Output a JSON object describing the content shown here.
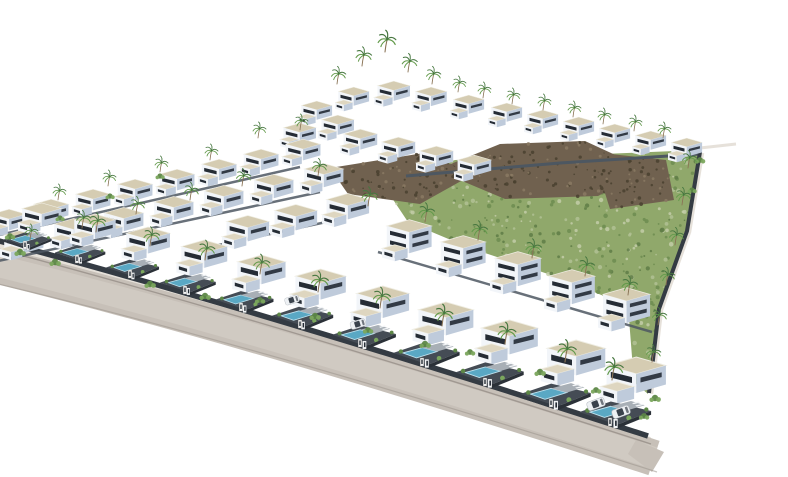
{
  "scene": {
    "name": "aerial-3d-render-villa-development",
    "colors": {
      "background": "#ffffff",
      "roof": "#d5ccb2",
      "roof2": "#ded6c0",
      "roofEdge": "#efede2",
      "faceLight": "#f2f5f9",
      "faceShade": "#bfcbdb",
      "window": "#252c35",
      "windowShade": "#323a45",
      "plot": "#454c55",
      "pool": "#5aa8c4",
      "poolEdge": "#bfe2ee",
      "terrace": "#a8afb6",
      "post": "#f2f4f6",
      "shrub": "#5d8747",
      "shrub2": "#7ba75d",
      "wallDark": "#343b43",
      "wallDark2": "#2b3138",
      "ridgeWall": "#4d5761",
      "hill": "#90a86b",
      "hillDot1": "#6d8c50",
      "hillDot2": "#b2c194",
      "hillDot3": "#c3cda8",
      "hillDot4": "#5f7d46",
      "rock": "#70614f",
      "rockDark": "#49412f",
      "rockLight": "#8a7a63",
      "road": "#c7c0b8",
      "roadLight": "#d2ccc4",
      "roadEdge": "#9b948d",
      "sidewalk": "#e6e1da",
      "palmTrunk": "#8a7456",
      "palmFrond": "#477740",
      "palmFrond2": "#639a4b",
      "car": "#eef1f4",
      "carGlass": "#3a424c",
      "carEdge": "#b9bec4"
    },
    "hill": {
      "points": "405,176 455,160 700,150 686,232 658,310 648,394 634,382 628,306 560,278 470,248 408,222 392,198",
      "dots": 340
    },
    "rocks": [
      {
        "points": "436,170 500,144 585,141 648,170 598,196 505,199",
        "dots": 110
      },
      {
        "points": "592,152 666,160 674,200 610,209",
        "dots": 55
      },
      {
        "points": "330,168 430,152 470,176 420,204 348,194",
        "dots": 70
      }
    ],
    "road": {
      "main": "M -10,264 Q 264,331 654,458",
      "sidewalk": "M -10,243 Q 262,315 650,440",
      "curb": "M -10,247 Q 263,319 651,444",
      "bottom": "M -10,282 Q 267,348 657,472",
      "cornerTail": "636,440 664,452 652,472 628,454"
    },
    "walls": {
      "street": "M -12,238 Q 262,311 648,436",
      "right": "M 700,152 L 687,231 L 659,309 L 649,393",
      "rightOuter": "M 703,153 L 690,232 L 662,310 L 652,394",
      "pier": "M 700,148 L 736,144",
      "ridge": "M 406,176 L 560,163 L 700,154",
      "rowBases": [
        "M -14,238 L 300,167",
        "M -44,270 L 320,192",
        "M 205,248 L 345,218",
        "M 378,252 L 652,332"
      ]
    },
    "villas": [
      {
        "name": "hilltop-cluster",
        "variant": "basic",
        "homes": [
          [
            335,
            86,
            0.55
          ],
          [
            374,
            80,
            0.58
          ],
          [
            412,
            86,
            0.56
          ],
          [
            450,
            94,
            0.55
          ],
          [
            298,
            100,
            0.55
          ],
          [
            318,
            114,
            0.58
          ],
          [
            280,
            122,
            0.58
          ]
        ]
      },
      {
        "name": "upper-row-right",
        "variant": "basic",
        "homes": [
          [
            488,
            102,
            0.55
          ],
          [
            524,
            109,
            0.55
          ],
          [
            560,
            116,
            0.55
          ],
          [
            596,
            123,
            0.55
          ],
          [
            632,
            130,
            0.55
          ],
          [
            668,
            137,
            0.55
          ]
        ]
      },
      {
        "name": "upper-row-2",
        "variant": "basic",
        "homes": [
          [
            340,
            128,
            0.6
          ],
          [
            378,
            136,
            0.6
          ],
          [
            416,
            145,
            0.6
          ],
          [
            454,
            154,
            0.6
          ]
        ]
      },
      {
        "name": "left-row-1",
        "variant": "basic",
        "homes": [
          [
            282,
            138,
            0.62
          ],
          [
            240,
            148,
            0.62
          ],
          [
            198,
            158,
            0.62
          ],
          [
            156,
            168,
            0.62
          ],
          [
            114,
            178,
            0.62
          ],
          [
            72,
            188,
            0.62
          ],
          [
            30,
            198,
            0.62
          ],
          [
            -12,
            208,
            0.62
          ]
        ]
      },
      {
        "name": "left-row-2",
        "variant": "basic",
        "homes": [
          [
            300,
            162,
            0.7
          ],
          [
            250,
            173,
            0.7
          ],
          [
            200,
            184,
            0.7
          ],
          [
            150,
            195,
            0.7
          ],
          [
            100,
            206,
            0.7
          ],
          [
            50,
            217,
            0.7
          ],
          [
            0,
            228,
            0.7
          ]
        ]
      },
      {
        "name": "left-row-3",
        "variant": "basic",
        "homes": [
          [
            322,
            192,
            0.76
          ],
          [
            270,
            203,
            0.76
          ],
          [
            222,
            214,
            0.76
          ]
        ]
      },
      {
        "name": "mid-row",
        "variant": "tall",
        "homes": [
          [
            382,
            218,
            0.8
          ],
          [
            436,
            234,
            0.8
          ],
          [
            490,
            250,
            0.82
          ],
          [
            544,
            268,
            0.82
          ],
          [
            598,
            286,
            0.84
          ]
        ]
      },
      {
        "name": "front-row",
        "variant": "pool",
        "homes": [
          [
            4,
            203,
            0.7
          ],
          [
            55,
            214,
            0.74
          ],
          [
            106,
            227,
            0.78
          ],
          [
            160,
            240,
            0.82
          ],
          [
            215,
            255,
            0.86
          ],
          [
            272,
            269,
            0.9
          ],
          [
            332,
            286,
            0.94
          ],
          [
            393,
            302,
            0.98
          ],
          [
            455,
            320,
            1.01
          ],
          [
            520,
            340,
            1.04
          ],
          [
            579,
            357,
            1.06
          ]
        ]
      }
    ],
    "posts": [
      [
        25,
        247
      ],
      [
        77,
        261
      ],
      [
        130,
        276
      ],
      [
        185,
        292
      ],
      [
        241,
        309
      ],
      [
        300,
        326
      ],
      [
        360,
        345
      ],
      [
        422,
        364
      ],
      [
        485,
        384
      ],
      [
        551,
        405
      ],
      [
        610,
        424
      ]
    ],
    "palms": [
      [
        337,
        84,
        0.55
      ],
      [
        362,
        66,
        0.6
      ],
      [
        385,
        52,
        0.68
      ],
      [
        408,
        72,
        0.58
      ],
      [
        432,
        84,
        0.55
      ],
      [
        458,
        92,
        0.5
      ],
      [
        483,
        98,
        0.5
      ],
      [
        512,
        104,
        0.5
      ],
      [
        543,
        110,
        0.5
      ],
      [
        573,
        117,
        0.5
      ],
      [
        603,
        124,
        0.5
      ],
      [
        634,
        131,
        0.5
      ],
      [
        663,
        138,
        0.5
      ],
      [
        258,
        138,
        0.5
      ],
      [
        300,
        130,
        0.5
      ],
      [
        210,
        160,
        0.5
      ],
      [
        160,
        172,
        0.5
      ],
      [
        108,
        186,
        0.5
      ],
      [
        58,
        200,
        0.5
      ],
      [
        242,
        186,
        0.55
      ],
      [
        190,
        200,
        0.55
      ],
      [
        136,
        214,
        0.55
      ],
      [
        82,
        228,
        0.55
      ],
      [
        30,
        240,
        0.5
      ],
      [
        318,
        176,
        0.55
      ],
      [
        368,
        206,
        0.6
      ],
      [
        425,
        222,
        0.6
      ],
      [
        478,
        240,
        0.6
      ],
      [
        532,
        258,
        0.6
      ],
      [
        585,
        276,
        0.6
      ],
      [
        628,
        295,
        0.6
      ],
      [
        96,
        232,
        0.6
      ],
      [
        150,
        246,
        0.6
      ],
      [
        205,
        260,
        0.62
      ],
      [
        260,
        274,
        0.62
      ],
      [
        318,
        292,
        0.65
      ],
      [
        380,
        308,
        0.65
      ],
      [
        442,
        326,
        0.68
      ],
      [
        505,
        344,
        0.68
      ],
      [
        565,
        362,
        0.7
      ],
      [
        612,
        380,
        0.7
      ],
      [
        688,
        168,
        0.55
      ],
      [
        682,
        205,
        0.55
      ],
      [
        675,
        245,
        0.55
      ],
      [
        666,
        285,
        0.55
      ],
      [
        658,
        325,
        0.55
      ],
      [
        652,
        362,
        0.55
      ]
    ],
    "shrubs": [
      [
        20,
        252,
        1
      ],
      [
        55,
        262,
        1
      ],
      [
        10,
        236,
        0.9
      ],
      [
        150,
        284,
        1
      ],
      [
        205,
        296,
        1
      ],
      [
        260,
        300,
        0.9
      ],
      [
        315,
        316,
        1
      ],
      [
        368,
        330,
        0.9
      ],
      [
        425,
        344,
        1
      ],
      [
        470,
        352,
        0.9
      ],
      [
        540,
        372,
        1
      ],
      [
        596,
        390,
        0.9
      ],
      [
        60,
        218,
        0.8
      ],
      [
        110,
        196,
        0.8
      ],
      [
        160,
        176,
        0.8
      ],
      [
        655,
        398,
        1
      ],
      [
        644,
        416,
        0.9
      ],
      [
        700,
        160,
        0.9
      ],
      [
        692,
        190,
        0.8
      ]
    ],
    "cars": [
      [
        596,
        404,
        -20,
        1
      ],
      [
        621,
        412,
        -20,
        1
      ],
      [
        292,
        300,
        -17,
        0.8
      ],
      [
        358,
        324,
        -17,
        0.85
      ]
    ]
  }
}
